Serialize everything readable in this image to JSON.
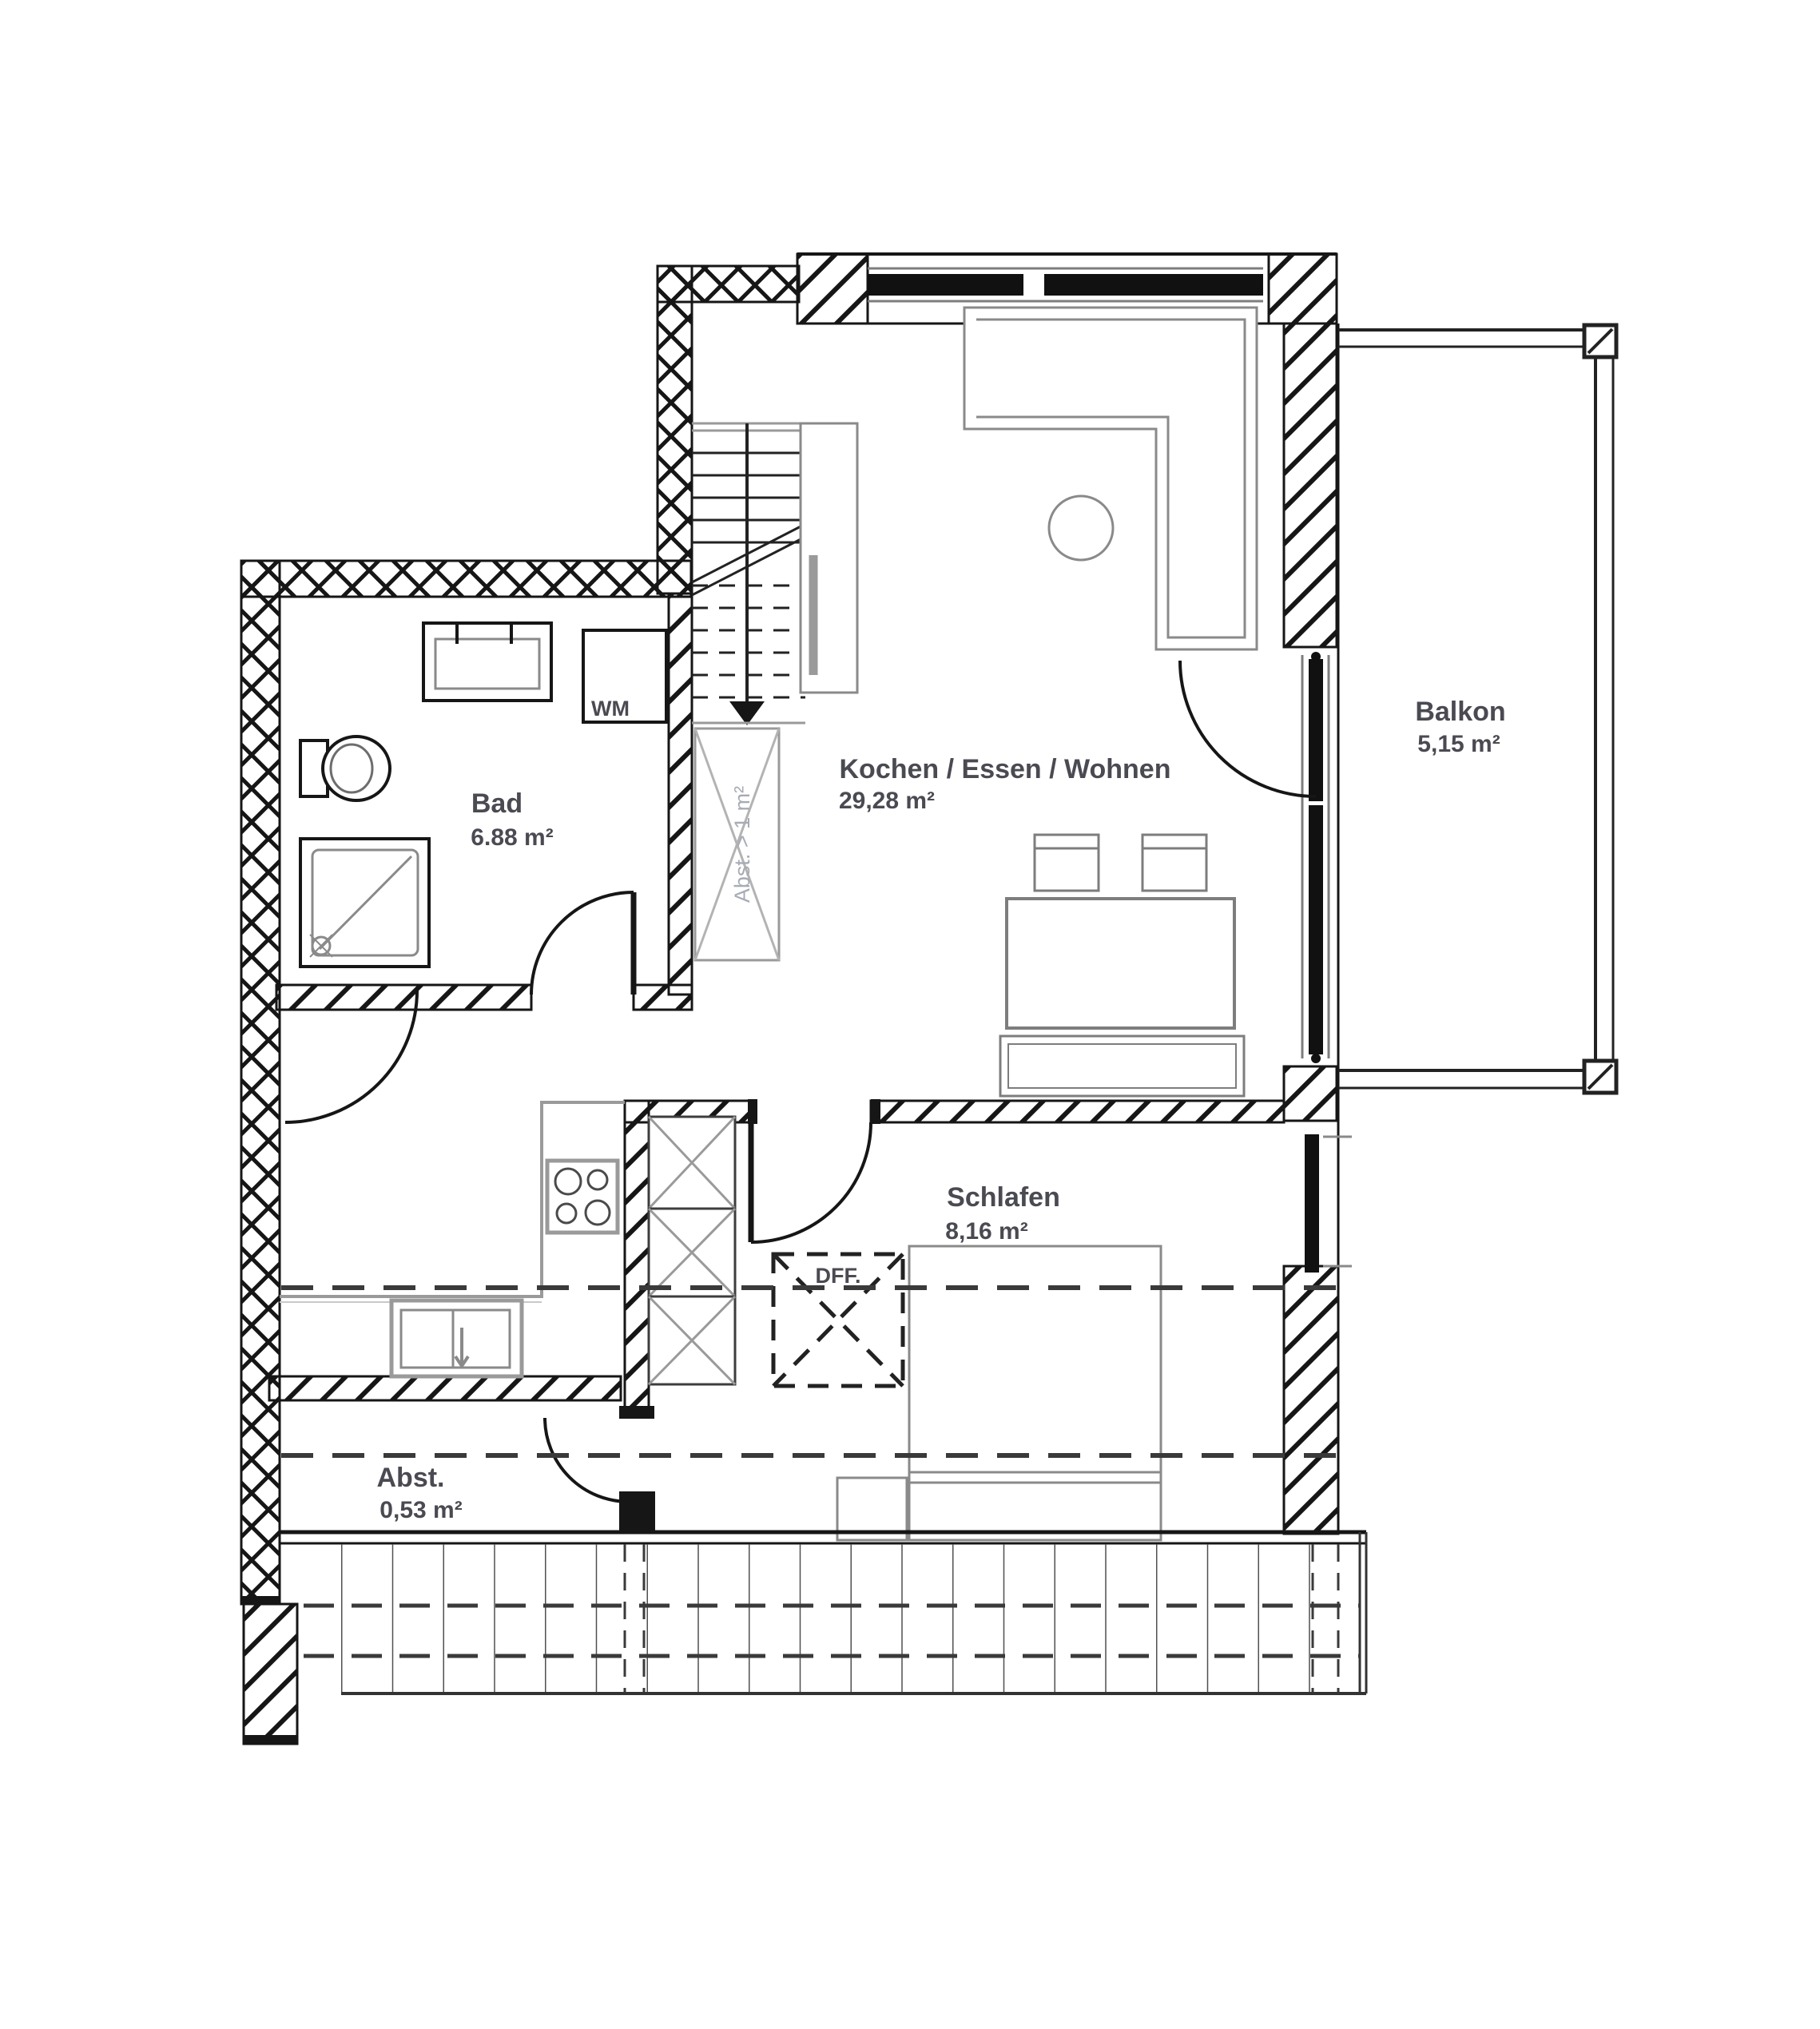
{
  "drawing": {
    "kind": "floor-plan",
    "floor": "attic apartment",
    "units": "m²"
  },
  "rooms": [
    {
      "name": "Bad",
      "area": "6.88 m²"
    },
    {
      "name": "Kochen / Essen / Wohnen",
      "area": "29,28 m²"
    },
    {
      "name": "Schlafen",
      "area": "8,16 m²"
    },
    {
      "name": "Balkon",
      "area": "5,15 m²"
    },
    {
      "name": "Abst.",
      "area": "0,53 m²"
    }
  ],
  "markers": {
    "washing_machine": "WM",
    "roof_window": "DFF.",
    "knee_wall_void": "Abst. > 1 m²"
  },
  "furniture": [
    "washbasin",
    "toilet",
    "shower",
    "washing-machine",
    "stairs",
    "wardrobe",
    "sofa",
    "side-table",
    "dining-table",
    "chairs",
    "bench",
    "kitchen-counter",
    "stove",
    "sink",
    "tall-cabinets",
    "bed",
    "nightstand"
  ],
  "colors": {
    "wall_line": "#161616",
    "furniture_line": "#8a8a8a",
    "label_text": "#4a4a52",
    "void_text": "#a6abb5",
    "background": "#ffffff"
  }
}
